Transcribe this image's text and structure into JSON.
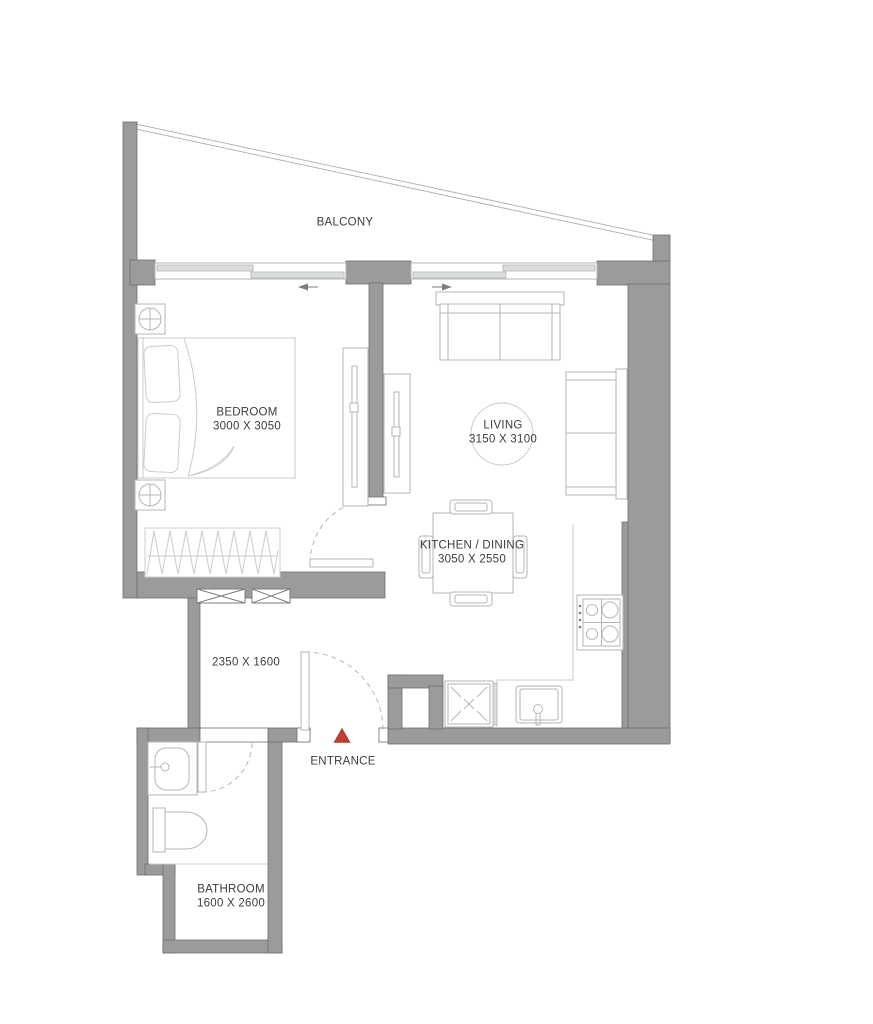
{
  "plan": {
    "type": "apartment-floor-plan",
    "unit": "1 bedroom apartment"
  },
  "colors": {
    "wall": "#9b9b9b",
    "wall_edge": "#6f6f6f",
    "furniture_line": "#b2b6b8",
    "furniture_line_soft": "#c9ccce",
    "outline_dark": "#7a7e80",
    "text": "#3c3c3c",
    "entrance_marker": "#c63b30",
    "glass_fill": "#dcdddd"
  },
  "rooms": {
    "balcony": {
      "label": "BALCONY"
    },
    "bedroom": {
      "label": "BEDROOM",
      "dimensions": "3000 X 3050"
    },
    "living": {
      "label": "LIVING",
      "dimensions": "3150 X 3100"
    },
    "kitchen_dining": {
      "label": "KITCHEN / DINING",
      "dimensions": "3050 X 2550"
    },
    "hallway": {
      "dimensions": "2350 X 1600"
    },
    "bathroom": {
      "label": "BATHROOM",
      "dimensions": "1600 X 2600"
    },
    "entrance": {
      "label": "ENTRANCE"
    }
  }
}
